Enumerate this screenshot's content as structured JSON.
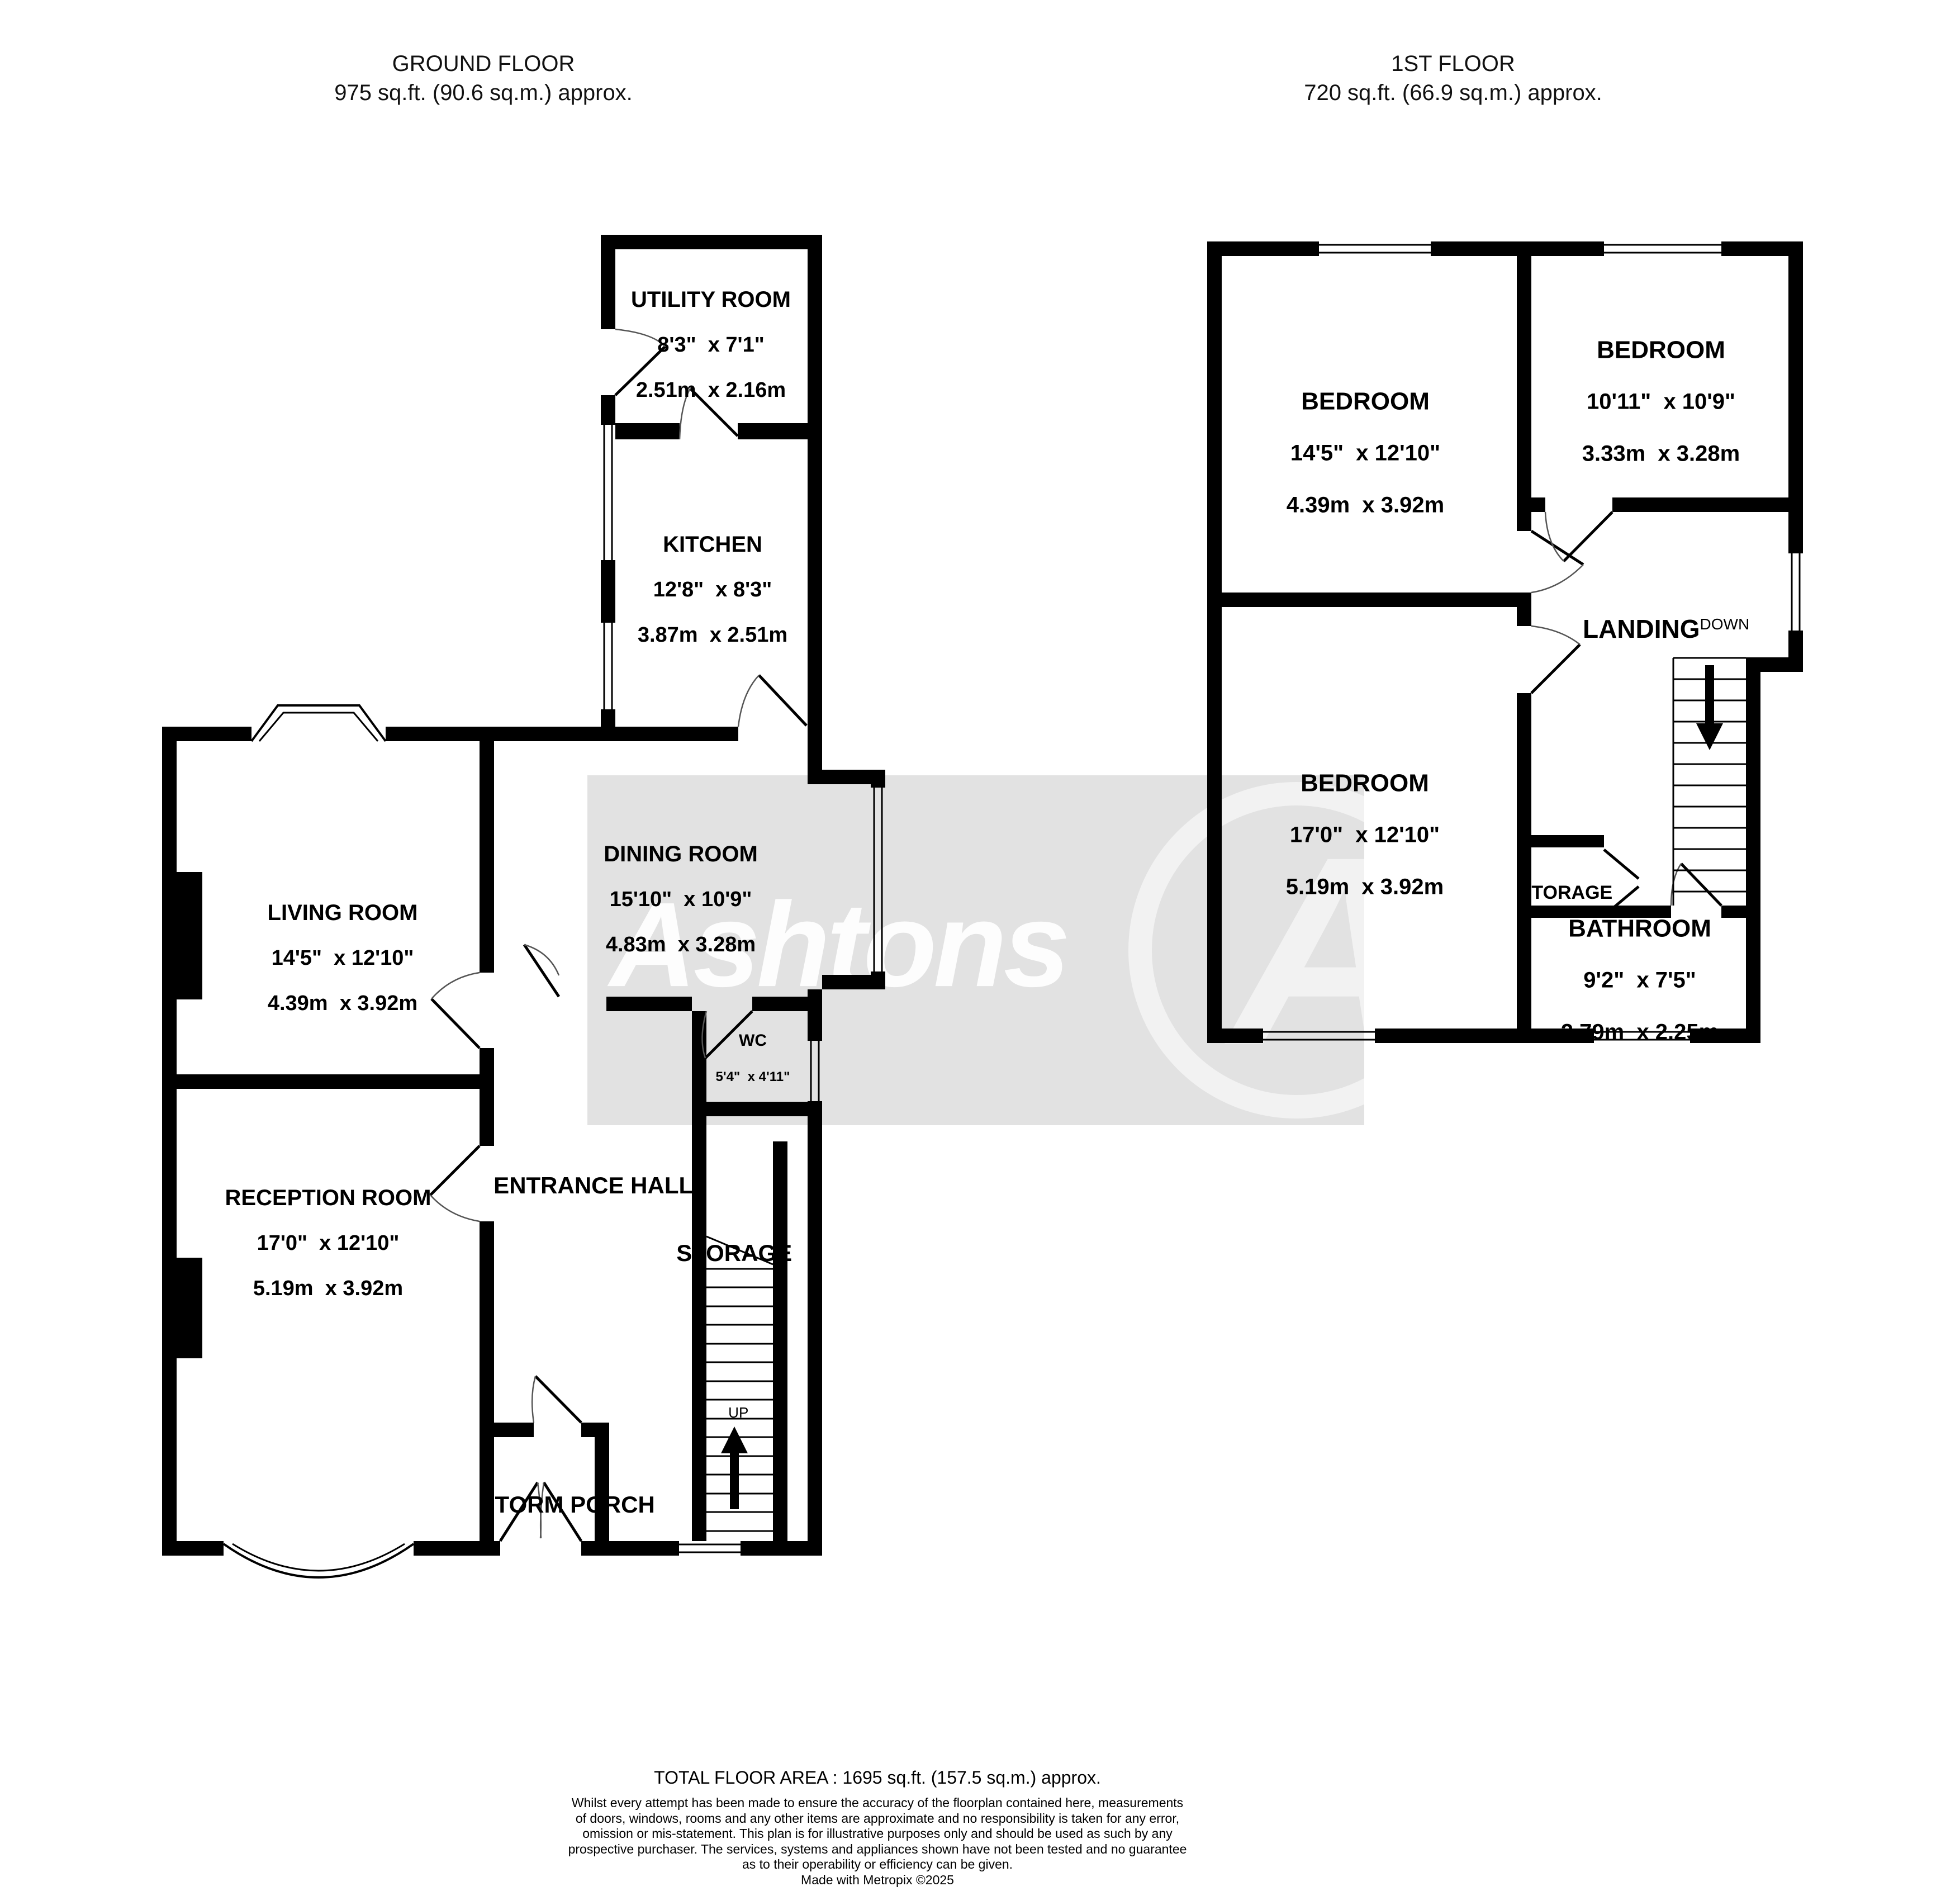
{
  "ground": {
    "title": "GROUND FLOOR",
    "area": "975 sq.ft. (90.6 sq.m.) approx.",
    "rooms": {
      "utility": {
        "name": "UTILITY ROOM",
        "imperial": "8'3\"  x 7'1\"",
        "metric": "2.51m  x 2.16m"
      },
      "kitchen": {
        "name": "KITCHEN",
        "imperial": "12'8\"  x 8'3\"",
        "metric": "3.87m  x 2.51m"
      },
      "dining": {
        "name": "DINING ROOM",
        "imperial": "15'10\"  x 10'9\"",
        "metric": "4.83m  x 3.28m"
      },
      "living": {
        "name": "LIVING ROOM",
        "imperial": "14'5\"  x 12'10\"",
        "metric": "4.39m  x 3.92m"
      },
      "reception": {
        "name": "RECEPTION ROOM",
        "imperial": "17'0\"  x 12'10\"",
        "metric": "5.19m  x 3.92m"
      },
      "entrance_hall": {
        "name": "ENTRANCE HALL"
      },
      "wc": {
        "name": "WC",
        "imperial": "5'4\"  x 4'11\"",
        "metric": "1.63m  x 1.49m"
      },
      "storage": {
        "name": "STORAGE"
      },
      "storm_porch": {
        "name": "STORM PORCH"
      },
      "up": "UP"
    }
  },
  "first": {
    "title": "1ST FLOOR",
    "area": "720 sq.ft. (66.9 sq.m.) approx.",
    "rooms": {
      "bedroom1": {
        "name": "BEDROOM",
        "imperial": "14'5\"  x 12'10\"",
        "metric": "4.39m  x 3.92m"
      },
      "bedroom2": {
        "name": "BEDROOM",
        "imperial": "10'11\"  x 10'9\"",
        "metric": "3.33m  x 3.28m"
      },
      "bedroom3": {
        "name": "BEDROOM",
        "imperial": "17'0\"  x 12'10\"",
        "metric": "5.19m  x 3.92m"
      },
      "landing": {
        "name": "LANDING",
        "down": "DOWN"
      },
      "storage": {
        "name": "STORAGE"
      },
      "bathroom": {
        "name": "BATHROOM",
        "imperial": "9'2\"  x 7'5\"",
        "metric": "2.79m  x 2.25m"
      }
    }
  },
  "watermark": {
    "brand": "Ashtons",
    "logo_letter": "A",
    "bg_color": "#e2e2e2"
  },
  "footer": {
    "total": "TOTAL FLOOR AREA : 1695 sq.ft. (157.5 sq.m.) approx.",
    "lines": [
      "Whilst every attempt has been made to ensure the accuracy of the floorplan contained here, measurements",
      "of doors, windows, rooms and any other items are approximate and no responsibility is taken for any error,",
      "omission or mis-statement. This plan is for illustrative purposes only and should be used as such by any",
      "prospective purchaser. The services, systems and appliances shown have not been tested and no guarantee",
      "as to their operability or efficiency can be given."
    ],
    "credit": "Made with Metropix ©2025"
  },
  "colors": {
    "wall": "#000000",
    "watermark_bg": "#e2e2e2",
    "text": "#000000"
  }
}
